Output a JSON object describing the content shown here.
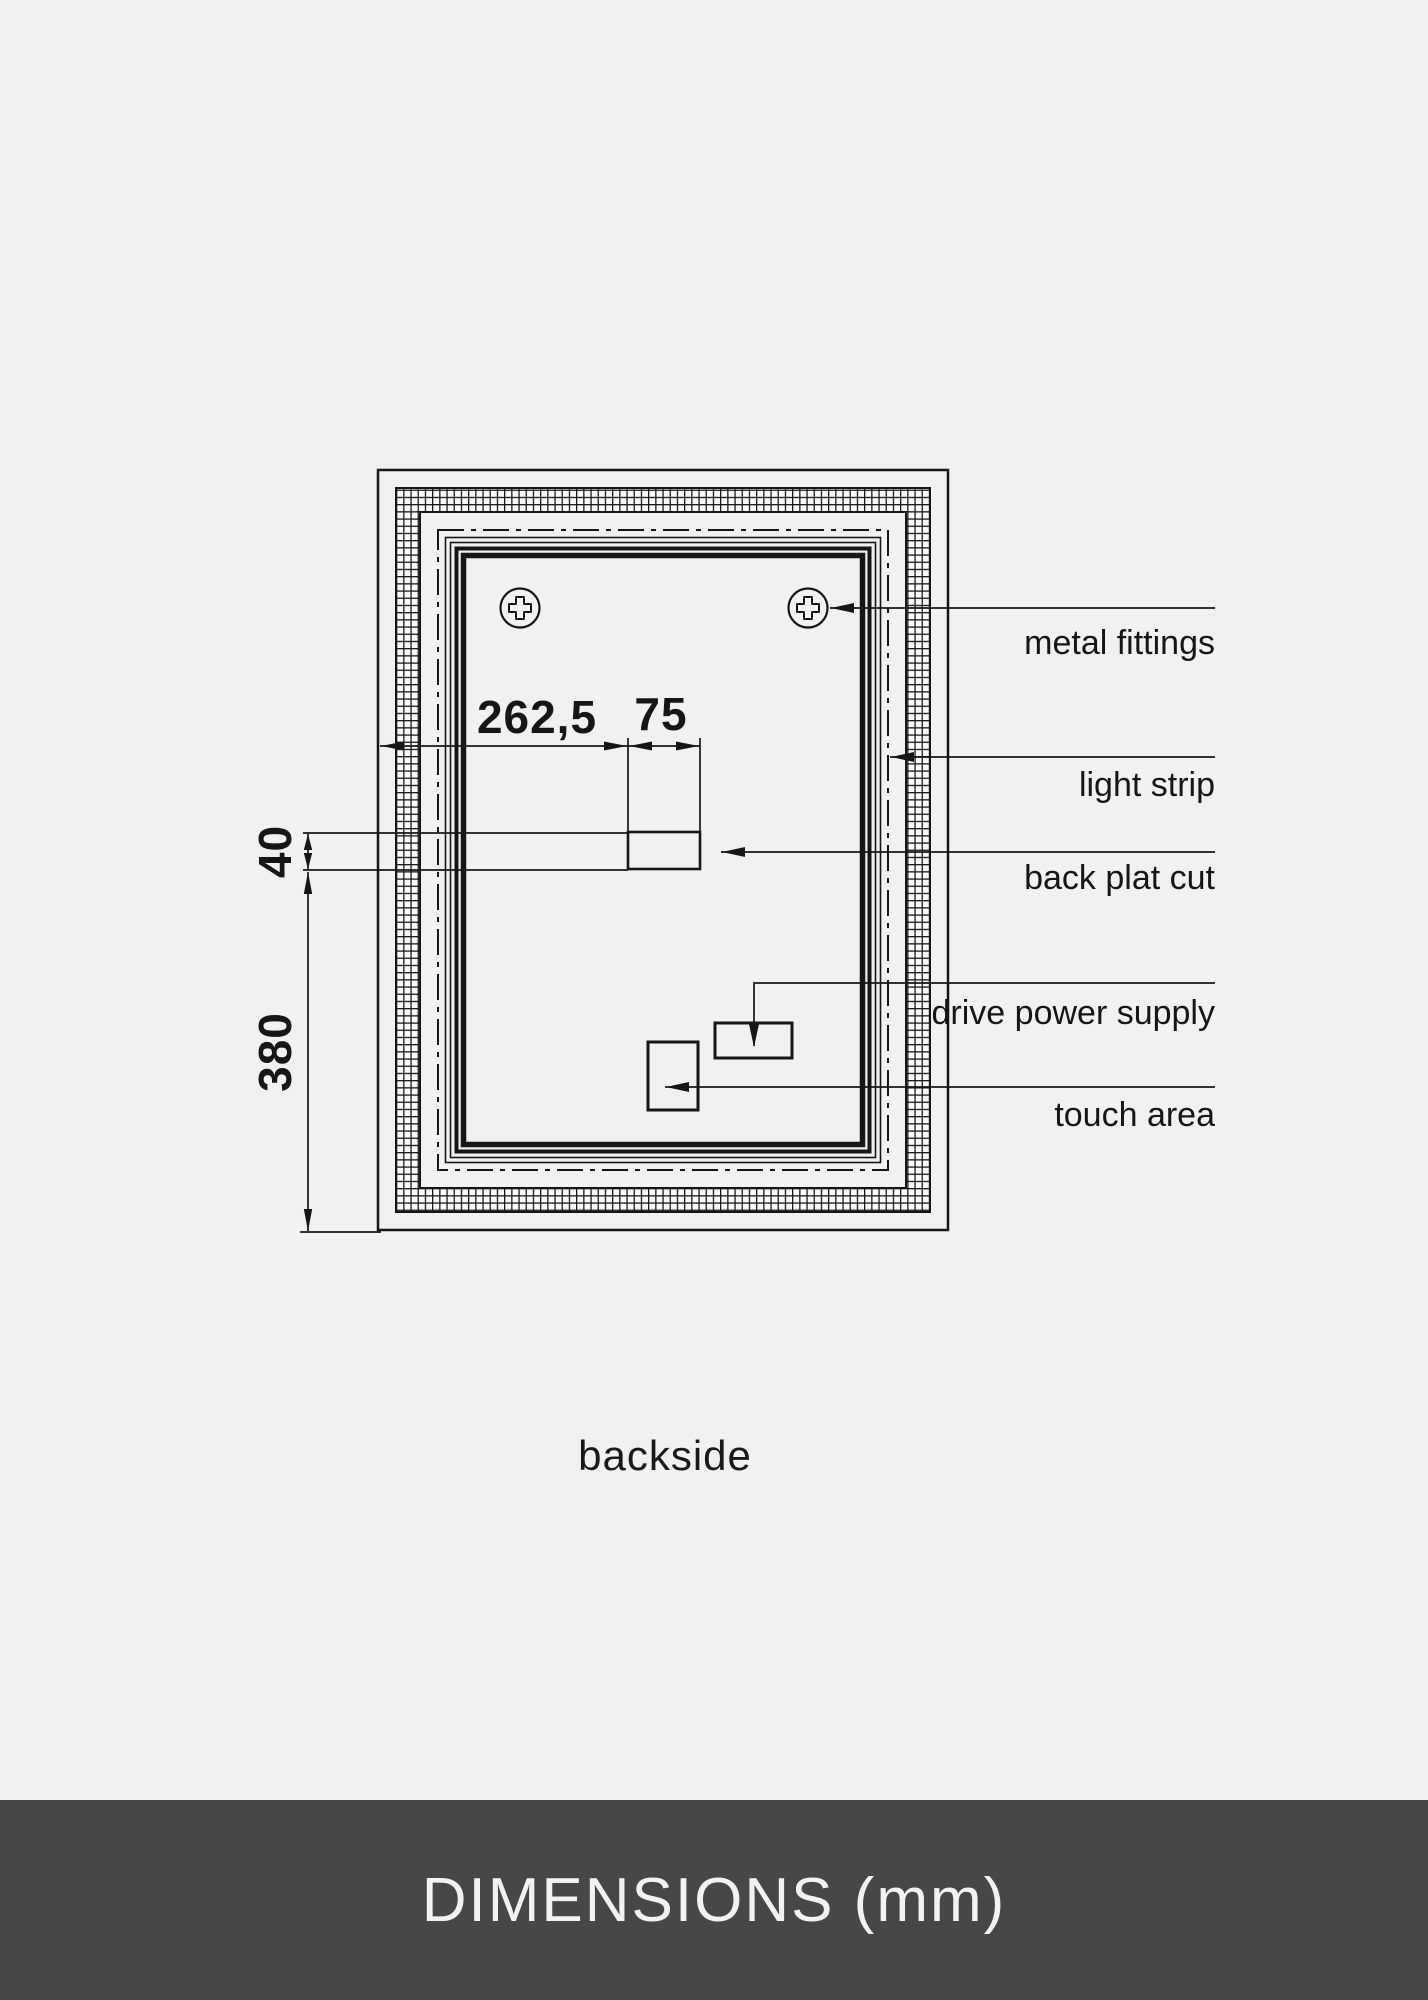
{
  "colors": {
    "background": "#f1f1f2",
    "line": "#161616",
    "hatch_fill": "#fbfbfb",
    "footer_bar": "#474747",
    "footer_text": "#f2f2f2"
  },
  "drawing": {
    "caption": "backside",
    "dims": {
      "offset_left": "262,5",
      "cut_width": "75",
      "cut_height": "40",
      "height_lower": "380"
    },
    "callouts": {
      "metal_fittings": "metal fittings",
      "light_strip": "light strip",
      "back_plat_cut": "back plat cut",
      "drive_power_supply": "drive power supply",
      "touch_area": "touch area"
    }
  },
  "footer": {
    "title": "DIMENSIONS (mm)"
  }
}
